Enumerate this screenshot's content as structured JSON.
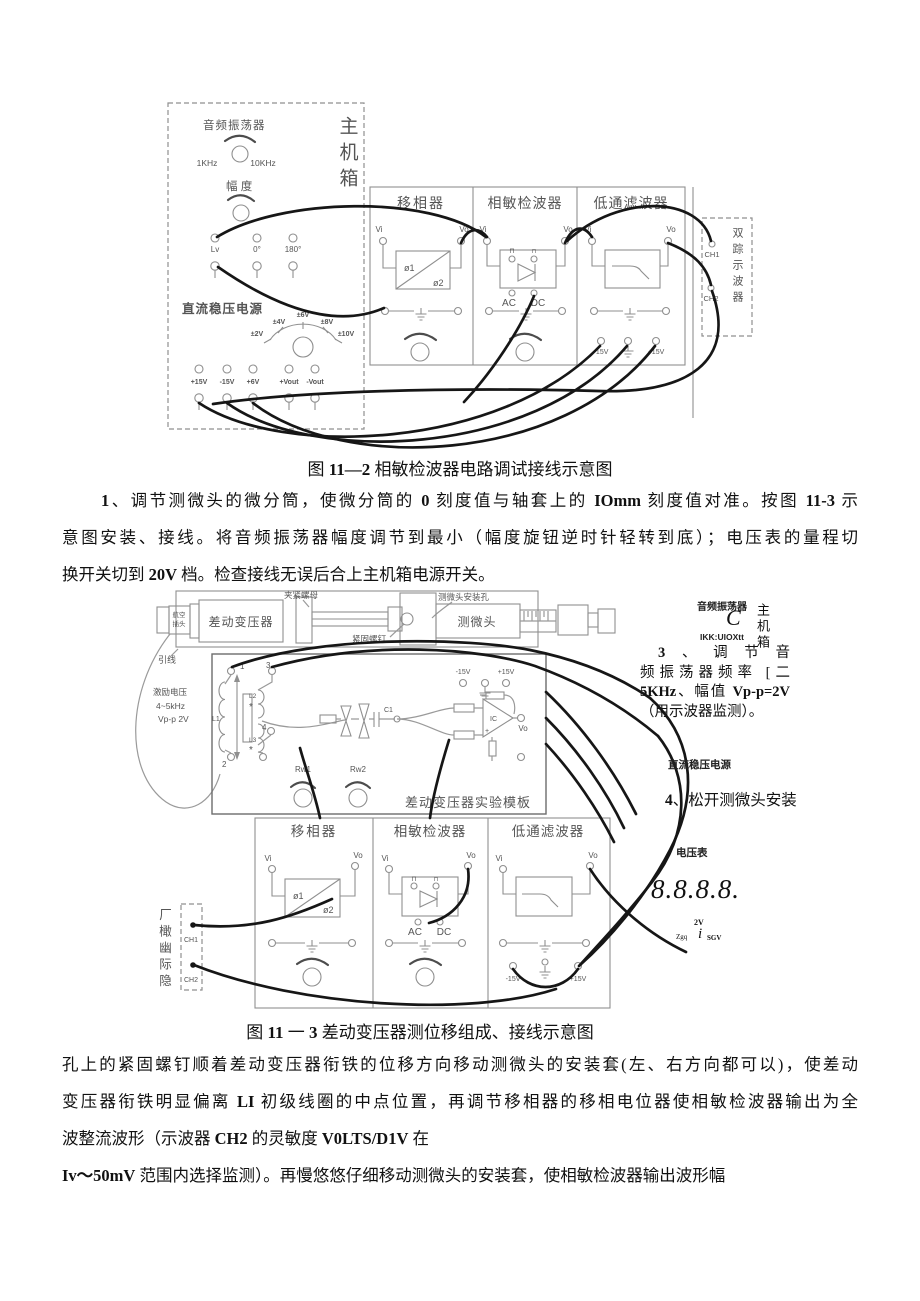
{
  "colors": {
    "pos": "#c03030",
    "neg": "#3838b8"
  },
  "fig1": {
    "caption_segments": [
      {
        "t": "图 "
      },
      {
        "t": "11—2",
        "b": true
      },
      {
        "t": " 相敏检波器电路调试接线示意图"
      }
    ],
    "labels": {
      "chassis": "主机箱",
      "osc": "音频振荡器",
      "freq_left": "1KHz",
      "freq_right": "10KHz",
      "amp": "幅 度",
      "t_lv": "Lv",
      "t_0": "0°",
      "t_180": "180°",
      "dc_supply": "直流稳压电源",
      "dial_2": "±2V",
      "dial_4": "±4V",
      "dial_6": "±6V",
      "dial_8": "±8V",
      "dial_10": "±10V",
      "pt_p15": "+15V",
      "pt_m15": "-15V",
      "pt_p6": "+6V",
      "pt_pvout": "+Vout",
      "pt_mvout": "-Vout",
      "m1": "移相器",
      "m2": "相敏检波器",
      "m3": "低通滤波器",
      "vi": "Vi",
      "vo": "Vo",
      "phi1": "ø1",
      "phi2": "ø2",
      "pulse": "⊓",
      "ac": "AC",
      "dc": "DC",
      "m15": "-15V",
      "p15": "+15V",
      "scope": "双踪示波器",
      "ch1": "CH1",
      "ch2": "CH2"
    }
  },
  "para1": {
    "lines": [
      [
        {
          "t": "1",
          "b": true
        },
        {
          "t": "、调节测微头的微分筒，使微分筒的 "
        },
        {
          "t": "0",
          "b": true
        },
        {
          "t": " 刻度值与轴套上的 "
        },
        {
          "t": "IOmm",
          "b": true
        },
        {
          "t": " 刻度值对准。按图 "
        },
        {
          "t": "11-3",
          "b": true
        },
        {
          "t": " 示"
        }
      ],
      [
        {
          "t": "意图安装、接线。将音频振荡器幅度调节到最小（幅度旋钮逆时针轻转到底）；电压表的量程切"
        }
      ],
      [
        {
          "t": "换开关切到 "
        },
        {
          "t": "20V",
          "b": true
        },
        {
          "t": " 档。检查接线无误后合上主机箱电源开关。"
        }
      ]
    ]
  },
  "fig2": {
    "caption_segments": [
      {
        "t": "图 "
      },
      {
        "t": "11",
        "b": true
      },
      {
        "t": " 一 "
      },
      {
        "t": "3",
        "b": true
      },
      {
        "t": " 差动变压器测位移组成、接线示意图"
      }
    ],
    "labels": {
      "plug_line1": "航空",
      "plug_line2": "插头",
      "lead": "引线",
      "transformer": "差动变压器",
      "clamp_nut": "夹紧螺母",
      "fasten_screw": "紧固螺钉",
      "mount_hole": "测微头安装孔",
      "micro_head": "测微头",
      "exc1": "激励电压",
      "exc2": "4~5kHz",
      "exc3": "Vp-p 2V",
      "n1": "1",
      "n2": "2",
      "n3": "3",
      "n4": "4",
      "L1": "L1",
      "L2": "L2",
      "L3": "L3",
      "star": "*",
      "rw1": "Rw1",
      "rw2": "Rw2",
      "c1": "C1",
      "ic": "IC",
      "plus": "+",
      "vo": "Vo",
      "vi": "Vi",
      "m15": "-15V",
      "p15": "+15V",
      "board": "差动变压器实验模板",
      "m1": "移相器",
      "m2": "相敏检波器",
      "m3": "低通滤波器",
      "phi1": "ø1",
      "phi2": "ø2",
      "pulse": "⊓",
      "ac": "AC",
      "dc": "DC",
      "scope_text": "厂橄幽际隐",
      "ch1": "CH1",
      "ch2": "CH2"
    }
  },
  "sidebar": {
    "osc_label": "音频振荡器",
    "osc_c": "C",
    "osc_range": "IKK:UIOXtt",
    "chassis": "主机箱",
    "step3_lines": [
      [
        {
          "t": "3",
          "b": true
        },
        {
          "t": "、调节音"
        }
      ],
      [
        {
          "t": "频振荡器频率 [二"
        }
      ],
      [
        {
          "t": "5KHz",
          "b": true
        },
        {
          "t": "、幅值 "
        },
        {
          "t": "Vp-p=2V",
          "b": true
        }
      ],
      [
        {
          "t": "（用示波器监测）。"
        }
      ]
    ],
    "dc_supply": "直流稳压电源",
    "step4": [
      {
        "t": "4",
        "b": true
      },
      {
        "t": "、松开测微头安装"
      }
    ],
    "voltmeter": "电压表",
    "display": "8.8.8.8.",
    "meter_top": "2V",
    "meter_left": "Zgq",
    "meter_i": "i",
    "meter_right": "SGV"
  },
  "para2": {
    "lines": [
      [
        {
          "t": "孔上的紧固螺钉顺着差动变压器衔铁的位移方向移动测微头的安装套(左、右方向都可以)，使差动"
        }
      ],
      [
        {
          "t": "变压器衔铁明显偏离 "
        },
        {
          "t": "LI",
          "b": true
        },
        {
          "t": " 初级线圈的中点位置，再调节移相器的移相电位器使相敏检波器输出为全"
        }
      ],
      [
        {
          "t": "波整流波形（示波器 "
        },
        {
          "t": "CH2",
          "b": true
        },
        {
          "t": " 的灵敏度 "
        },
        {
          "t": "V0LTS/D1V",
          "b": true
        },
        {
          "t": " 在"
        }
      ],
      [
        {
          "t": "Iv～50mV",
          "b": true
        },
        {
          "t": " 范围内选择监测）。再慢悠悠仔细移动测微头的安装套，使相敏检波器输出波形幅"
        }
      ]
    ]
  }
}
